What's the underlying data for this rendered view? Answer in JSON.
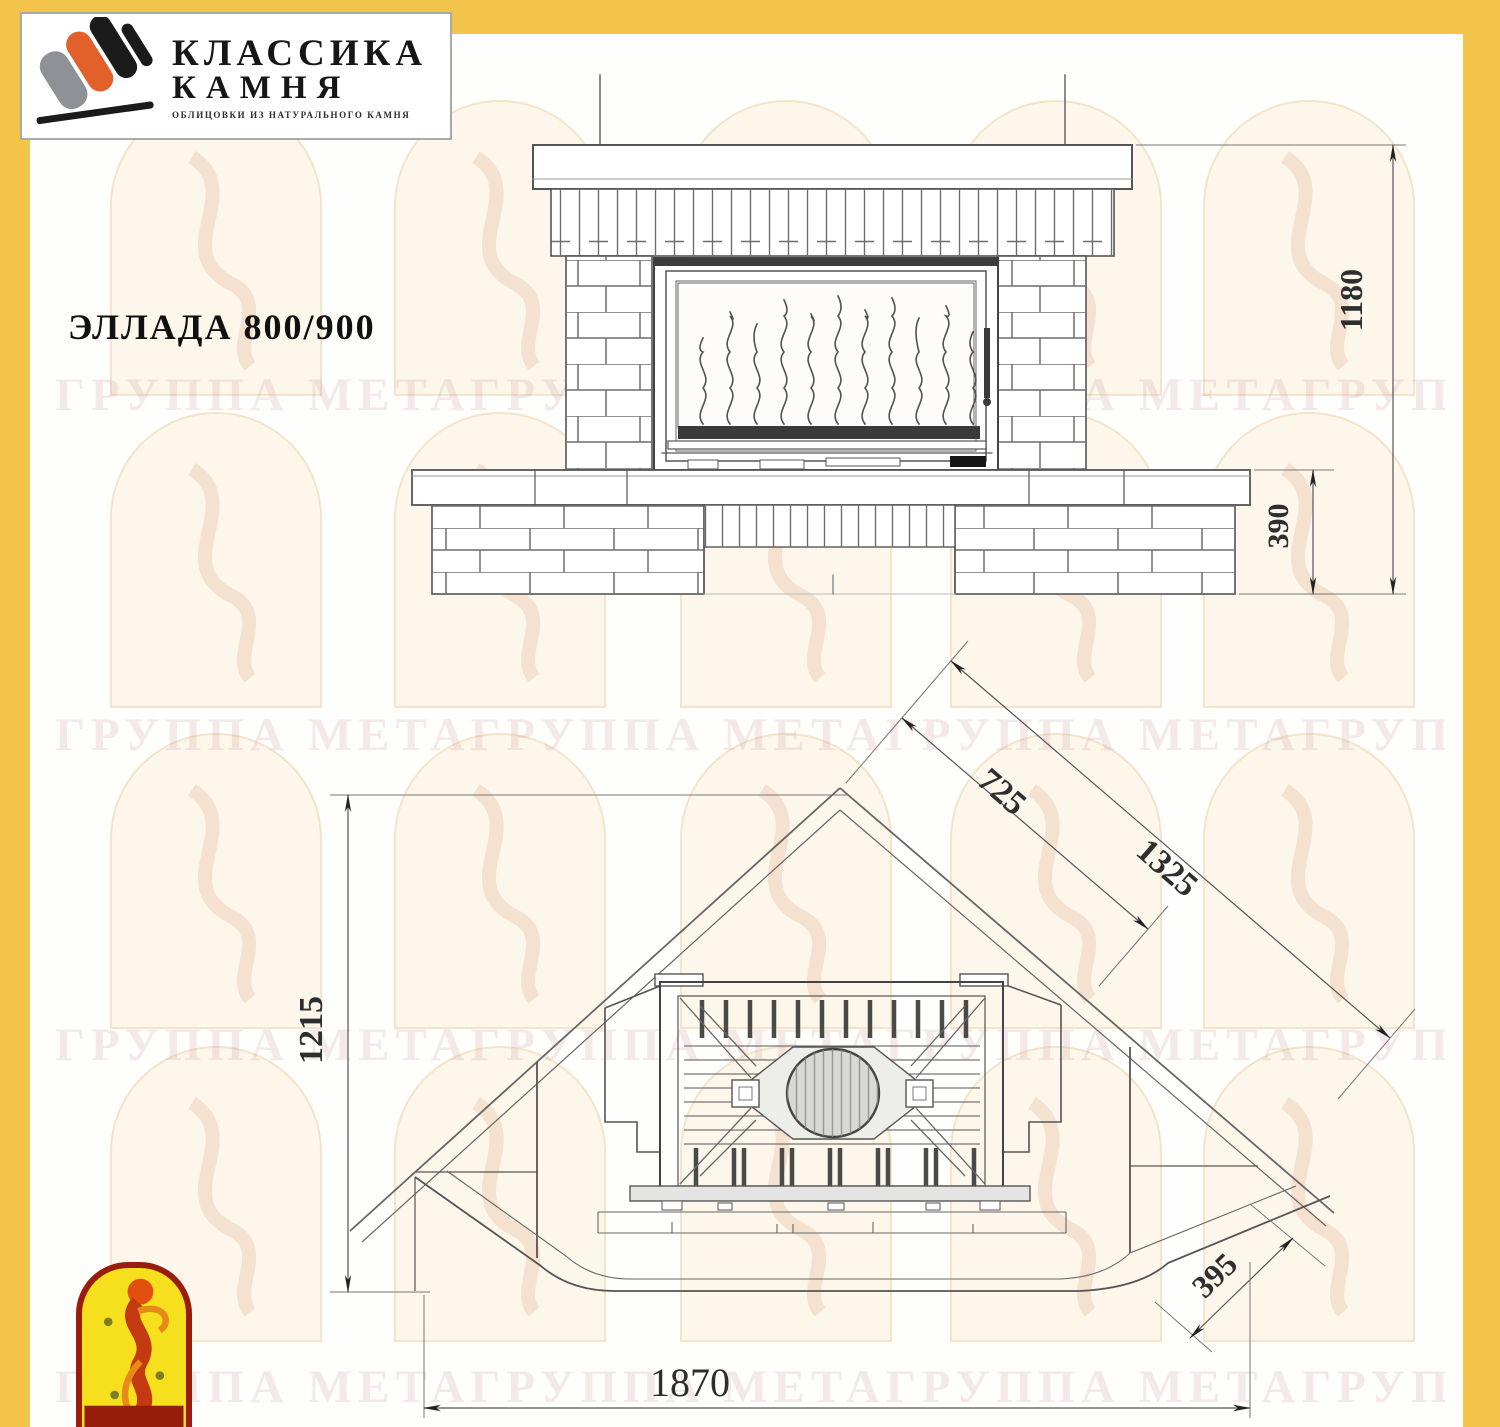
{
  "header": {
    "logo": {
      "line1": "КЛАССИКА",
      "line2": "КАМНЯ",
      "subtitle": "ОБЛИЦОВКИ ИЗ НАТУРАЛЬНОГО КАМНЯ"
    },
    "title": "ЭЛЛАДА 800/900"
  },
  "watermark": {
    "text": "ГРУППА МЕТАГРУППА МЕТАГРУППА МЕТАГРУППА МЕТА"
  },
  "front_view": {
    "dim_total_height": "1180",
    "dim_base_height": "390"
  },
  "plan_view": {
    "dim_depth": "1215",
    "dim_corner_inner": "725",
    "dim_corner_outer": "1325",
    "dim_side": "395",
    "dim_width": "1870"
  },
  "colors": {
    "frame_yellow": "#F3C64B",
    "logo_orange": "#E4602B",
    "logo_red": "#9A1C0C",
    "line_gray": "#555555"
  }
}
